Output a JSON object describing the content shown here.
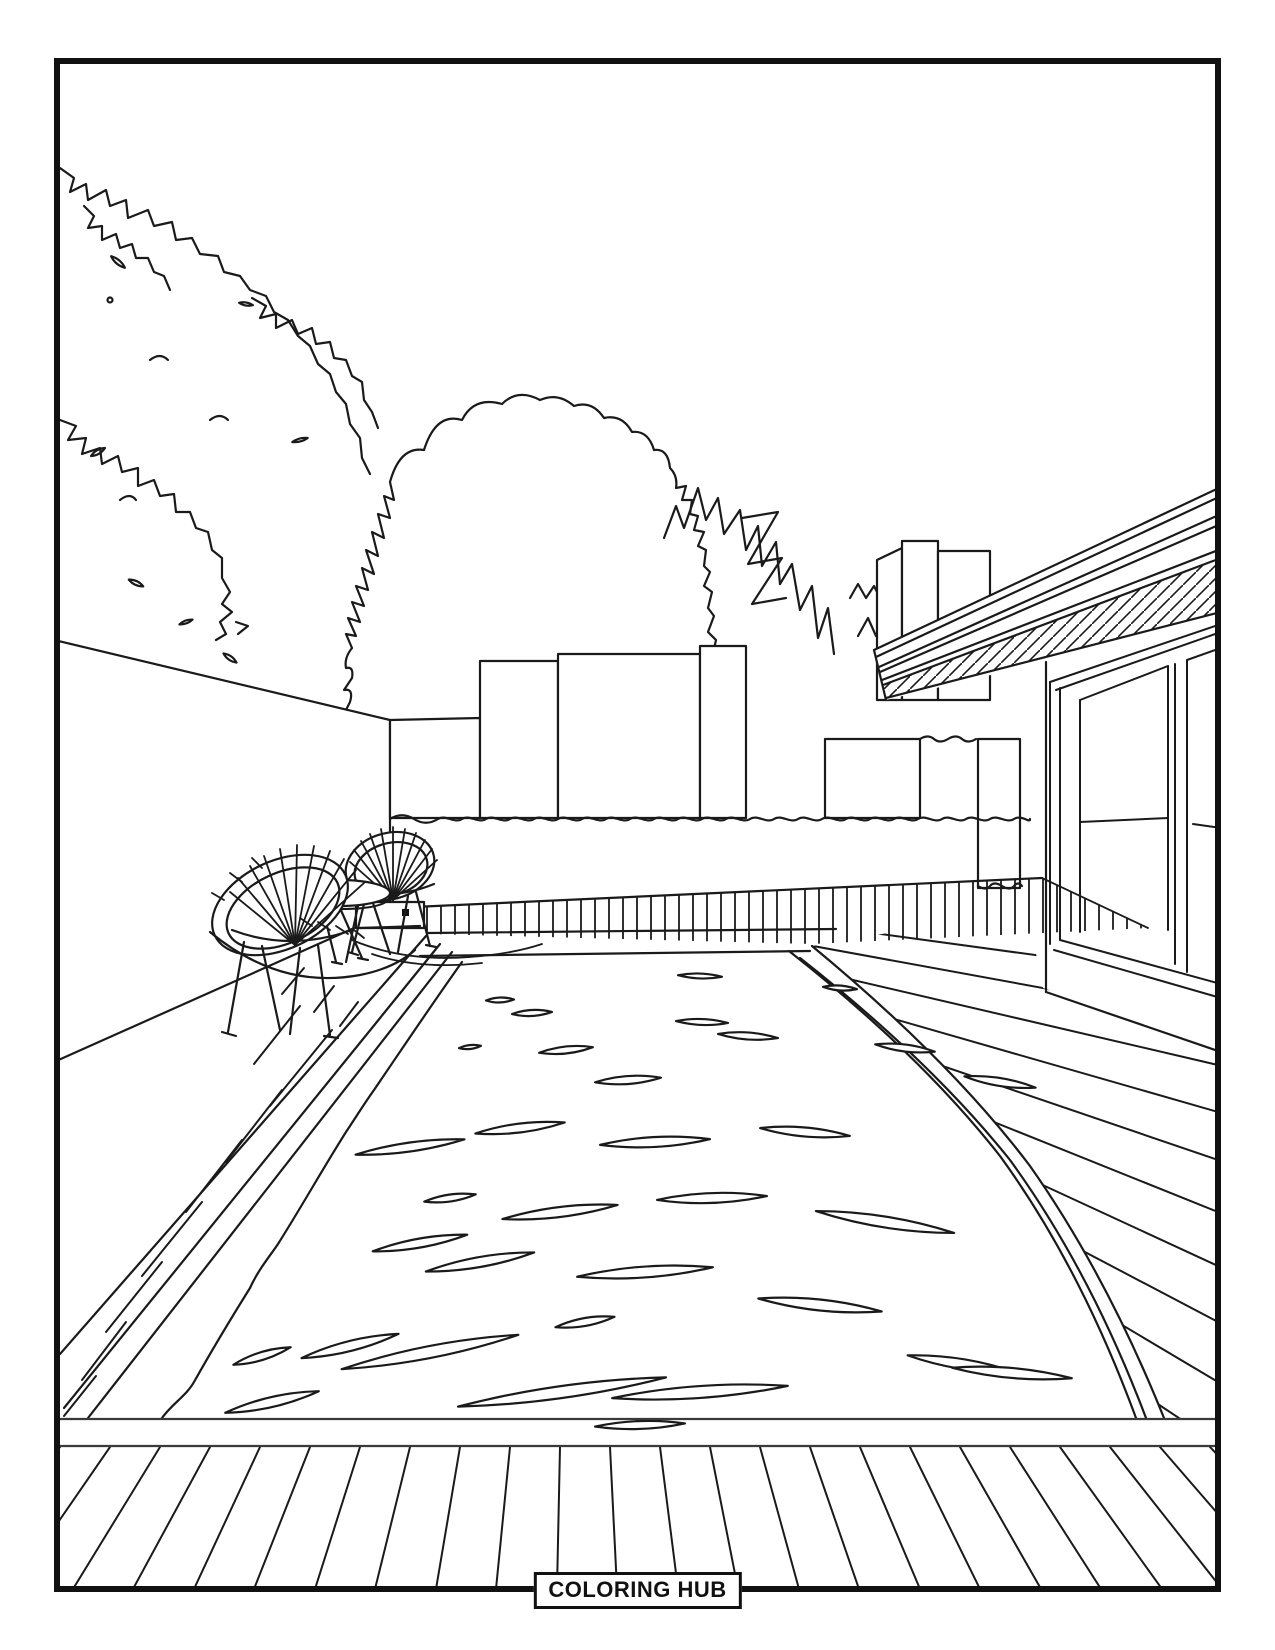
{
  "page": {
    "background_color": "#ffffff",
    "line_color": "#1a1a1a",
    "frame_color": "#111111"
  },
  "badge": {
    "label": "COLORING HUB"
  },
  "scene": {
    "type": "coloring-page line art",
    "subject": "Backyard swimming pool with wooden deck, two round woven patio chairs with a side table, hedge-topped wall, trees, and a modern flat-roof house with sliding glass doors",
    "elements": [
      "spiky foliage",
      "round tree canopy",
      "jagged trees",
      "boundary wall",
      "hedge",
      "background buildings",
      "chimney blocks",
      "flat roof with fascia and hatched soffit",
      "sliding glass doors",
      "far deck planks",
      "right deck planks",
      "left deck",
      "swimming pool",
      "water ripples",
      "pool coping",
      "bottom deck planks",
      "two patio chairs",
      "round side table"
    ]
  }
}
